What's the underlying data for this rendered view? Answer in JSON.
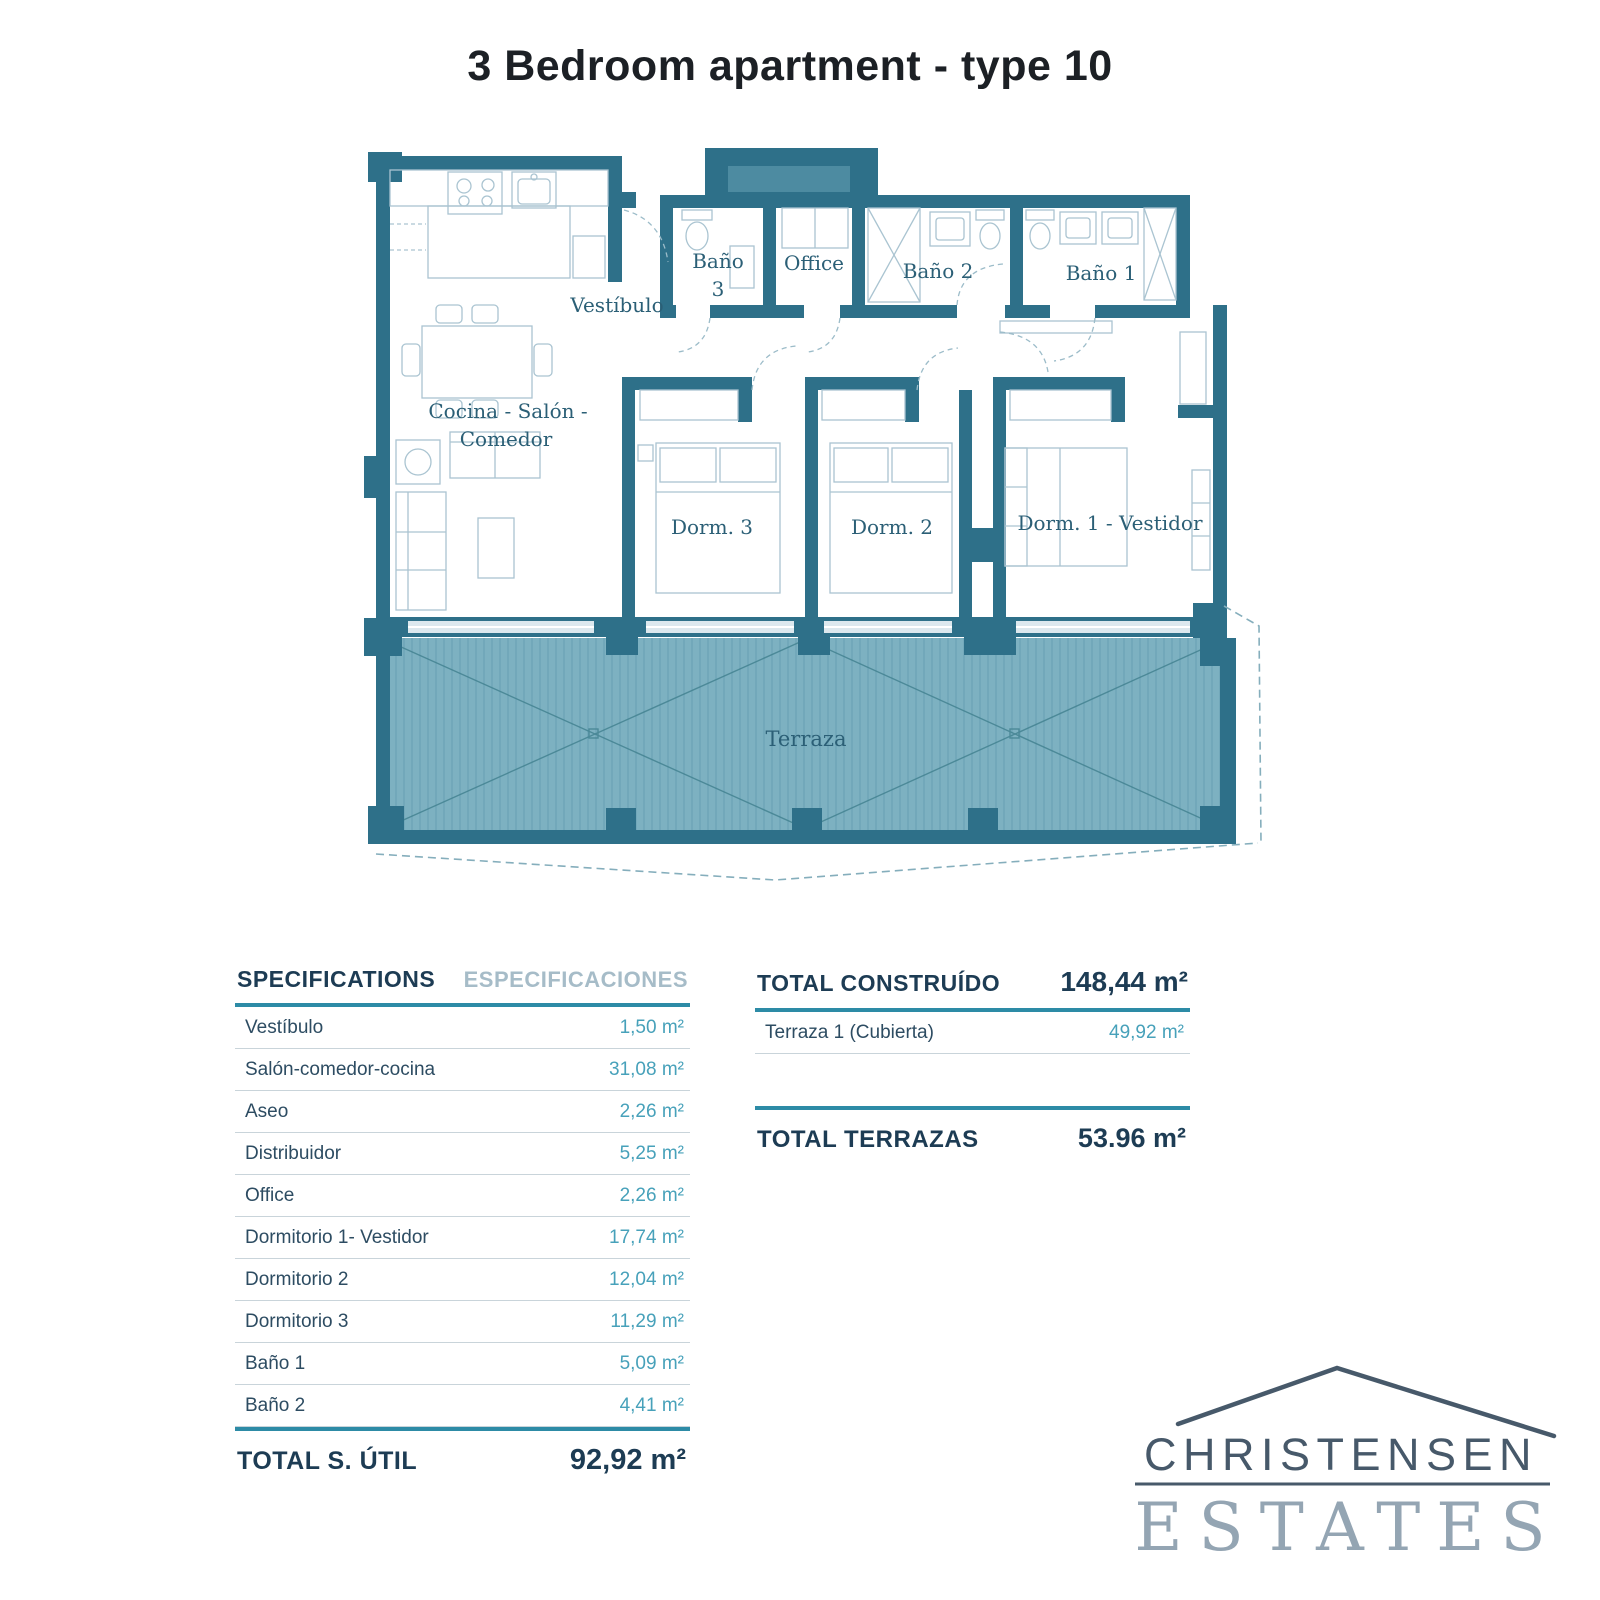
{
  "title": "3 Bedroom apartment - type 10",
  "plan": {
    "colors": {
      "wall": "#2e7089",
      "deck": "#7db1c1",
      "deck_stripe": "#6ba4b6",
      "label": "#2b5f76"
    },
    "rooms": {
      "vestibulo": "Vestíbulo",
      "bano3_line1": "Baño",
      "bano3_line2": "3",
      "office": "Office",
      "bano2": "Baño 2",
      "bano1": "Baño 1",
      "cocina_line1": "Cocina - Salón -",
      "cocina_line2": "Comedor",
      "dorm3": "Dorm. 3",
      "dorm2": "Dorm. 2",
      "dorm1": "Dorm. 1 - Vestidor",
      "terraza": "Terraza"
    }
  },
  "spec_table": {
    "header_left": "SPECIFICATIONS",
    "header_right": "ESPECIFICACIONES",
    "rows": [
      {
        "label": "Vestíbulo",
        "value": "1,50 m²"
      },
      {
        "label": "Salón-comedor-cocina",
        "value": "31,08 m²"
      },
      {
        "label": "Aseo",
        "value": "2,26 m²"
      },
      {
        "label": "Distribuidor",
        "value": "5,25 m²"
      },
      {
        "label": "Office",
        "value": "2,26 m²"
      },
      {
        "label": "Dormitorio 1- Vestidor",
        "value": "17,74 m²"
      },
      {
        "label": "Dormitorio 2",
        "value": "12,04 m²"
      },
      {
        "label": "Dormitorio 3",
        "value": "11,29 m²"
      },
      {
        "label": "Baño 1",
        "value": "5,09 m²"
      },
      {
        "label": "Baño 2",
        "value": "4,41 m²"
      }
    ],
    "total_label": "TOTAL S. ÚTIL",
    "total_value": "92,92 m²"
  },
  "built_table": {
    "header_label": "TOTAL CONSTRUÍDO",
    "header_value": "148,44 m²",
    "rows": [
      {
        "label": "Terraza 1 (Cubierta)",
        "value": "49,92 m²"
      }
    ],
    "total_label": "TOTAL TERRAZAS",
    "total_value": "53.96 m²"
  },
  "logo": {
    "line1": "CHRISTENSEN",
    "line2": "ESTATES"
  }
}
